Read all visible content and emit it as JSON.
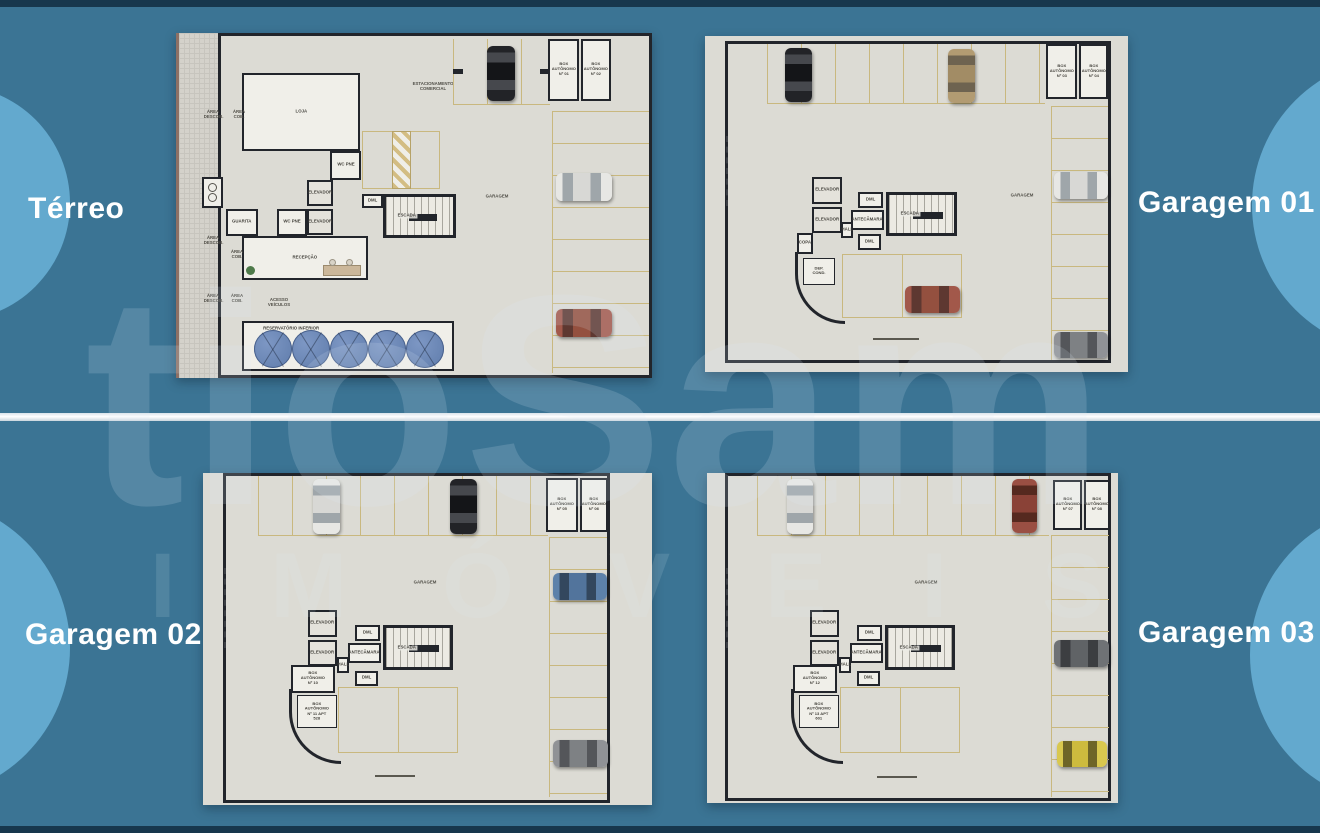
{
  "poster": {
    "background_color": "#3b7494",
    "circle_color": "#63a9ce",
    "edge_bar_color": "#17374d",
    "divider_color": "#ffffff",
    "paper_color": "#dcdbd4",
    "wall_color": "#22252b",
    "stall_line_color": "#c9b87f",
    "tank_color": "#6b86b5"
  },
  "watermark": {
    "line1": "tioSam",
    "line2": "IMÓVEIS"
  },
  "floor_labels": {
    "terreo": "Térreo",
    "garagem01": "Garagem 01",
    "garagem02": "Garagem 02",
    "garagem03": "Garagem 03"
  },
  "shared": {
    "elevador": "ELEVADOR",
    "escada": "ESCADA",
    "antecamara": "ANTECÂMARA",
    "hall": "HALL",
    "dml": "DML",
    "garagem": "GARAGEM",
    "wc_pne": "WC PNE"
  },
  "terreo": {
    "loja": "LOJA",
    "recepcao": "RECEPÇÃO",
    "guarita": "GUARITA",
    "lixo": "LIXO",
    "estacionamento_comercial": "ESTACIONAMENTO COMERCIAL",
    "area_descob": "ÁREA DESCOB.",
    "area_cob": "ÁREA COB.",
    "acesso_veiculos": "ACESSO VEÍCULOS",
    "reservatorio_inferior": "RESERVATÓRIO INFERIOR",
    "box_01": "BOX AUTÔNOMO Nº 01",
    "box_02": "BOX AUTÔNOMO Nº 02",
    "water_tanks": 5,
    "cars": [
      {
        "id": "black-car",
        "color": "#222327",
        "orientation": "vertical"
      },
      {
        "id": "white-car",
        "color": "#e7e7e4",
        "orientation": "horizontal"
      },
      {
        "id": "red-car",
        "color": "#a2584a",
        "orientation": "horizontal"
      }
    ]
  },
  "garagem01": {
    "copa": "COPA",
    "dep_cond": "DEP. COND.",
    "box_03": "BOX AUTÔNOMO Nº 03",
    "box_04": "BOX AUTÔNOMO Nº 04",
    "cars": [
      {
        "id": "black-car",
        "color": "#222327",
        "orientation": "vertical"
      },
      {
        "id": "tan-car",
        "color": "#b29b72",
        "orientation": "vertical"
      },
      {
        "id": "white-car",
        "color": "#e7e7e4",
        "orientation": "horizontal"
      },
      {
        "id": "red-car",
        "color": "#a2584a",
        "orientation": "horizontal"
      },
      {
        "id": "gray-car",
        "color": "#909296",
        "orientation": "horizontal"
      }
    ]
  },
  "garagem02": {
    "box_05": "BOX AUTÔNOMO Nº 05",
    "box_06": "BOX AUTÔNOMO Nº 06",
    "box_10": "BOX AUTÔNOMO Nº 10",
    "box_11": "BOX AUTÔNOMO Nº 11 APT 528",
    "cars": [
      {
        "id": "white-car",
        "color": "#e7e7e4",
        "orientation": "vertical"
      },
      {
        "id": "black-car",
        "color": "#222327",
        "orientation": "vertical"
      },
      {
        "id": "blue-car",
        "color": "#5d81aa",
        "orientation": "horizontal"
      },
      {
        "id": "gray-car",
        "color": "#909296",
        "orientation": "horizontal"
      }
    ]
  },
  "garagem03": {
    "box_07": "BOX AUTÔNOMO Nº 07",
    "box_08": "BOX AUTÔNOMO Nº 08",
    "box_12": "BOX AUTÔNOMO Nº 12",
    "box_13": "BOX AUTÔNOMO Nº 13 APT 601",
    "cars": [
      {
        "id": "white-car",
        "color": "#e7e7e4",
        "orientation": "vertical"
      },
      {
        "id": "darkred-car",
        "color": "#9a4f43",
        "orientation": "vertical"
      },
      {
        "id": "darkgray-car",
        "color": "#6f7275",
        "orientation": "horizontal"
      },
      {
        "id": "yellow-car",
        "color": "#d9c84f",
        "orientation": "horizontal"
      }
    ]
  }
}
